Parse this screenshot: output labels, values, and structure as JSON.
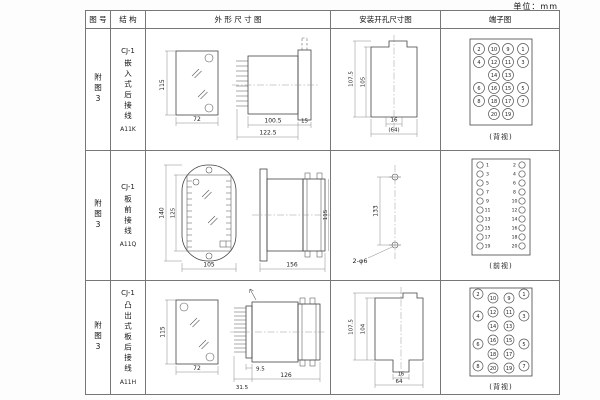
{
  "unit_label": "单位：mm",
  "header": {
    "fig_no": "图 号",
    "structure": "结 构",
    "outline": "外 形 尺 寸 图",
    "install": "安装开孔尺寸图",
    "terminal": "端子图"
  },
  "rows": [
    {
      "fig_no": "附图3",
      "model": "CJ-1",
      "mount_type": "嵌入式后接线",
      "code": "A11K",
      "outline": {
        "front_height": "115",
        "front_width": "72",
        "body_depth": "100.5",
        "total_depth": "122.5",
        "flange": "15"
      },
      "install": {
        "outer_height": "107.5",
        "inner_height": "105",
        "slot_width": "16",
        "panel_width": "(64)"
      },
      "terminal": {
        "view_label": "(背视)",
        "layout": "grid4",
        "cells": [
          [
            "2",
            "10",
            "9",
            "1"
          ],
          [
            "4",
            "12",
            "11",
            "3"
          ],
          [
            "",
            "14",
            "13",
            ""
          ],
          [
            "6",
            "16",
            "15",
            "5"
          ],
          [
            "8",
            "18",
            "17",
            "7"
          ],
          [
            "",
            "20",
            "19",
            ""
          ]
        ]
      }
    },
    {
      "fig_no": "附图3",
      "model": "CJ-1",
      "mount_type": "板前接线",
      "code": "A11Q",
      "outline": {
        "front_height": "140",
        "inner_height": "125",
        "front_width": "105",
        "total_depth": "156",
        "body_height": "115"
      },
      "install": {
        "hole_spacing": "133",
        "hole_label": "2-φ6"
      },
      "terminal": {
        "view_label": "(前视)",
        "layout": "dual",
        "left": [
          "1",
          "3",
          "5",
          "7",
          "9",
          "11",
          "13",
          "15",
          "17",
          "19"
        ],
        "right": [
          "2",
          "4",
          "6",
          "8",
          "10",
          "12",
          "14",
          "16",
          "18",
          "20"
        ]
      }
    },
    {
      "fig_no": "附图3",
      "model": "CJ-1",
      "mount_type": "凸出式板后接线",
      "code": "A11H",
      "outline": {
        "front_height": "115",
        "front_width": "72",
        "terminal_depth": "9.5",
        "base_depth": "31.5",
        "body_depth": "126"
      },
      "install": {
        "outer_height": "107.5",
        "inner_height": "104",
        "slot_width": "16",
        "panel_width": "64"
      },
      "terminal": {
        "view_label": "(背视)",
        "layout": "stagger",
        "outer_left": [
          "2",
          "4",
          "6",
          "8"
        ],
        "inner_left": [
          "10",
          "12",
          "14",
          "16",
          "18",
          "20"
        ],
        "inner_right": [
          "9",
          "11",
          "13",
          "15",
          "17",
          "19"
        ],
        "outer_right": [
          "1",
          "3",
          "5",
          "7"
        ]
      }
    }
  ]
}
